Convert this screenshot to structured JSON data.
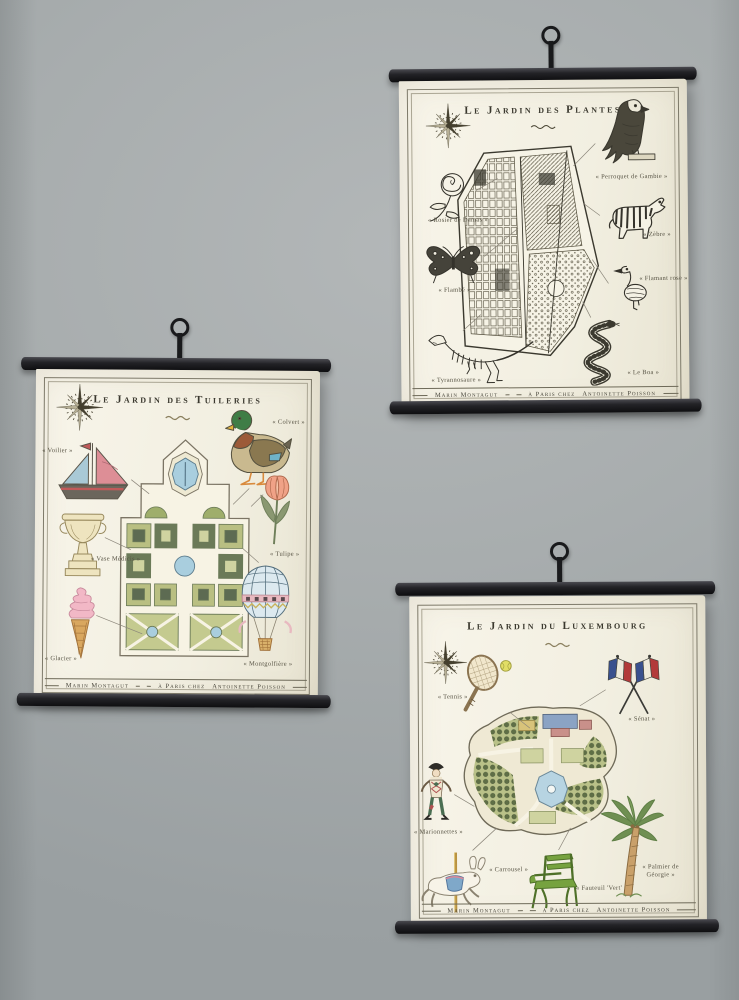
{
  "scene": {
    "wall_color": "#a8adae",
    "rod_color": "#191a1c",
    "paper_color": "#f4f1e5"
  },
  "posters": [
    {
      "id": "jardin-des-plantes",
      "title": "Le Jardin des Plantes",
      "credit": {
        "left": "Marin Montagut",
        "middle": "à Paris chez",
        "right": "Antoinette Poisson"
      },
      "items": [
        {
          "icon": "eagle-icon",
          "label": "« Perroquet de Gambie »"
        },
        {
          "icon": "rose-icon",
          "label": "« Rosier de Damas »"
        },
        {
          "icon": "butterfly-icon",
          "label": "« Flambé »"
        },
        {
          "icon": "zebra-icon",
          "label": "« Zèbre »"
        },
        {
          "icon": "flamingo-icon",
          "label": "« Flamant rose »"
        },
        {
          "icon": "trex-skeleton-icon",
          "label": "« Tyrannosaure »"
        },
        {
          "icon": "snake-icon",
          "label": "« Le Boa »"
        }
      ]
    },
    {
      "id": "jardin-des-tuileries",
      "title": "Le Jardin des Tuileries",
      "credit": {
        "left": "Marin Montagut",
        "middle": "à Paris chez",
        "right": "Antoinette Poisson"
      },
      "items": [
        {
          "icon": "sailboat-icon",
          "label": "« Voilier »"
        },
        {
          "icon": "mallard-duck-icon",
          "label": "« Colvert »"
        },
        {
          "icon": "medici-vase-icon",
          "label": "« Vase Médicis »"
        },
        {
          "icon": "tulip-icon",
          "label": "« Tulipe »"
        },
        {
          "icon": "ice-cream-icon",
          "label": "« Glacier »"
        },
        {
          "icon": "hot-air-balloon-icon",
          "label": "« Montgolfière »"
        }
      ]
    },
    {
      "id": "jardin-du-luxembourg",
      "title": "Le Jardin du Luxembourg",
      "credit": {
        "left": "Marin Montagut",
        "middle": "à Paris chez",
        "right": "Antoinette Poisson"
      },
      "items": [
        {
          "icon": "tennis-racket-icon",
          "label": "« Tennis »"
        },
        {
          "icon": "french-flags-icon",
          "label": "« Sénat »"
        },
        {
          "icon": "harlequin-icon",
          "label": "« Marionnettes »"
        },
        {
          "icon": "carousel-rabbit-icon",
          "label": "« Carrousel »"
        },
        {
          "icon": "garden-chair-icon",
          "label": "« Fauteuil 'Vert' »"
        },
        {
          "icon": "palm-tree-icon",
          "label": "« Palmier de Géorgie »"
        }
      ]
    }
  ]
}
